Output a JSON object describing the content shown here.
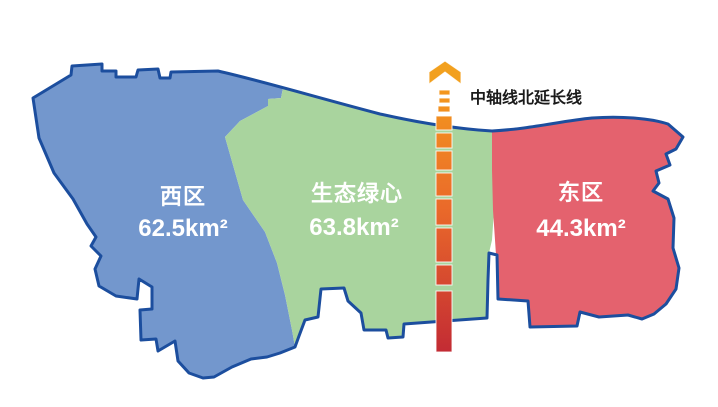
{
  "map": {
    "title_hidden": "",
    "background": "#ffffff",
    "outline_color": "#1c4e9e",
    "regions": [
      {
        "id": "west",
        "name": "西区",
        "area": "62.5km²",
        "fill": "#7397cd",
        "label_color": "#ffffff"
      },
      {
        "id": "green-heart",
        "name": "生态绿心",
        "area": "63.8km²",
        "fill": "#a9d49e",
        "label_color": "#ffffff"
      },
      {
        "id": "east",
        "name": "东区",
        "area": "44.3km²",
        "fill": "#e4626e",
        "label_color": "#ffffff"
      }
    ],
    "axis": {
      "label": "中轴线北延长线",
      "label_color": "#1a1a1a",
      "arrow_color": "#f2a01e",
      "gradient": [
        "#f6a31b",
        "#ea6a2a",
        "#c22a34"
      ]
    }
  }
}
